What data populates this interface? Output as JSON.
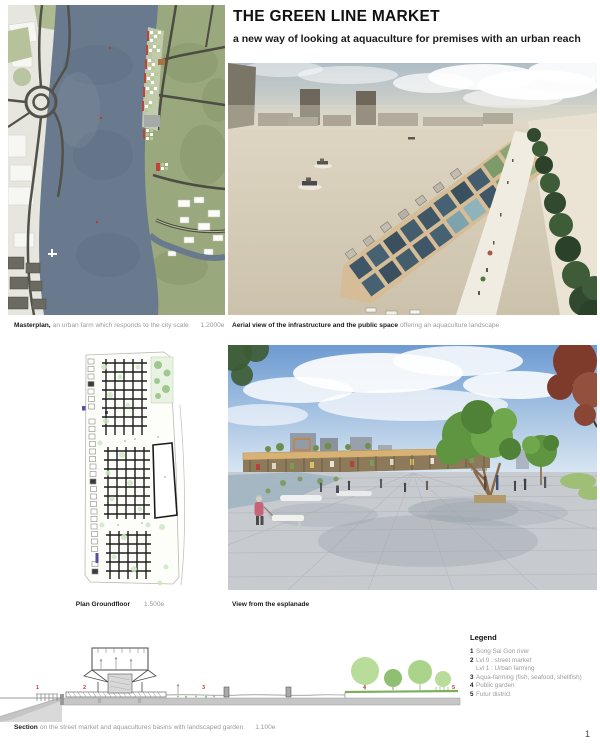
{
  "header": {
    "title": "THE GREEN LINE MARKET",
    "subtitle": "a new way of looking at aquaculture for premises with an urban reach"
  },
  "panels": {
    "masterplan": {
      "caption_bold": "Masterplan,",
      "caption_text": "an urban farm which responds to the city scale",
      "scale": "1.2000e"
    },
    "aerial": {
      "caption_bold": "Aerial view of the infrastructure and the public space",
      "caption_text": "offering an aquaculture landscape"
    },
    "plan": {
      "caption_bold": "Plan Groundfloor",
      "scale": "1.500e"
    },
    "esplanade": {
      "caption_bold": "View from the esplanade"
    },
    "section": {
      "caption_bold": "Section",
      "caption_text": "on the street market and aquacultures basins with landscaped garden",
      "scale": "1.100e",
      "markers": [
        "1",
        "2",
        "3",
        "4",
        "5"
      ]
    }
  },
  "legend": {
    "title": "Legend",
    "items": [
      {
        "num": "1",
        "text": "Song Sai Gon river"
      },
      {
        "num": "2",
        "text": "Lvl 0 : street market"
      },
      {
        "num": "",
        "text": "Lvl 1 : Urban farming"
      },
      {
        "num": "3",
        "text": "Aqua-farming (fish, seafood, shellfish)"
      },
      {
        "num": "4",
        "text": "Public garden"
      },
      {
        "num": "5",
        "text": "Futur district"
      }
    ]
  },
  "page": {
    "number": "1"
  },
  "colors": {
    "marker_red": "#c23b2e",
    "river_blue": "#6a7a8e",
    "basin_blue": "#3f5666",
    "field_green": "#9aa87e",
    "tree_green": "#5f9440",
    "walkway_tan": "#d6bd97",
    "caption_gray": "#9a9a9a"
  }
}
